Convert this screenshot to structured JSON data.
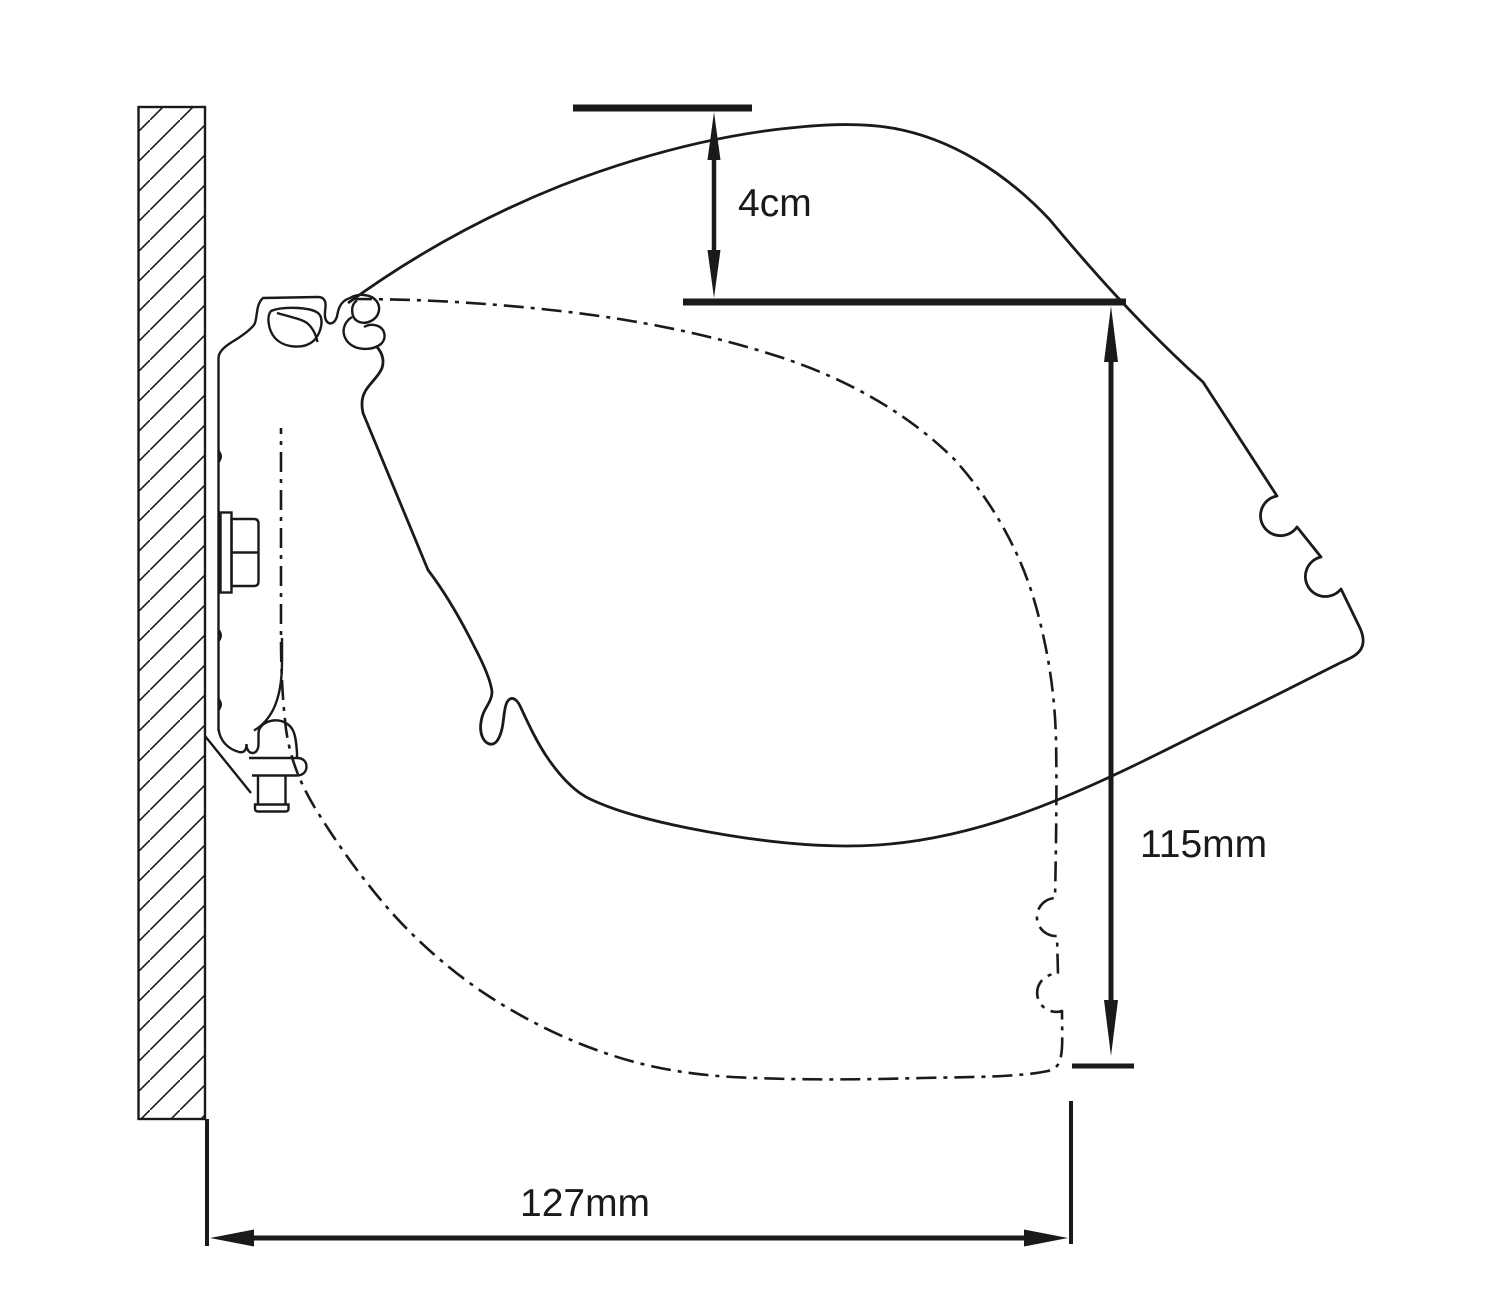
{
  "theme": {
    "ink": "#1a1a1a",
    "paper": "#ffffff"
  },
  "dimensions": {
    "drop": {
      "label": "4cm"
    },
    "height": {
      "label": "115mm"
    },
    "projection": {
      "label": "127mm"
    }
  }
}
